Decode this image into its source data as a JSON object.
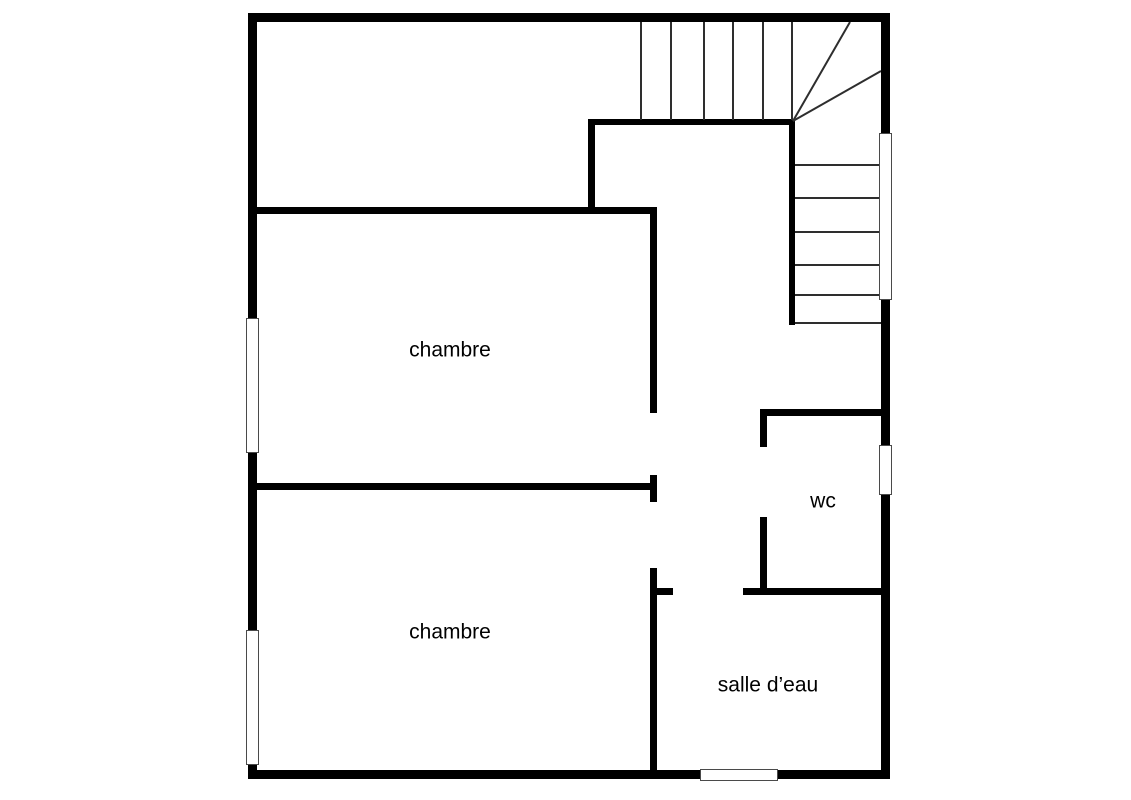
{
  "plan": {
    "type": "floor-plan-upper-storey",
    "background_color": "#ffffff",
    "wall_color": "#000000",
    "tread_line_color": "#2e2e2e",
    "rooms": [
      {
        "id": "chambre-1",
        "label": "chambre"
      },
      {
        "id": "chambre-2",
        "label": "chambre"
      },
      {
        "id": "wc",
        "label": "wc"
      },
      {
        "id": "salle-deau",
        "label": "salle d’eau"
      }
    ],
    "staircase": {
      "location": "top-right",
      "straight_treads_top_run": 6,
      "winder_treads": 3,
      "straight_treads_right_run": 6
    },
    "windows": [
      {
        "wall": "left",
        "beside": "chambre-1"
      },
      {
        "wall": "left",
        "beside": "chambre-2"
      },
      {
        "wall": "right",
        "beside": "staircase"
      },
      {
        "wall": "right",
        "beside": "wc"
      },
      {
        "wall": "bottom",
        "beside": "salle-deau"
      }
    ]
  }
}
